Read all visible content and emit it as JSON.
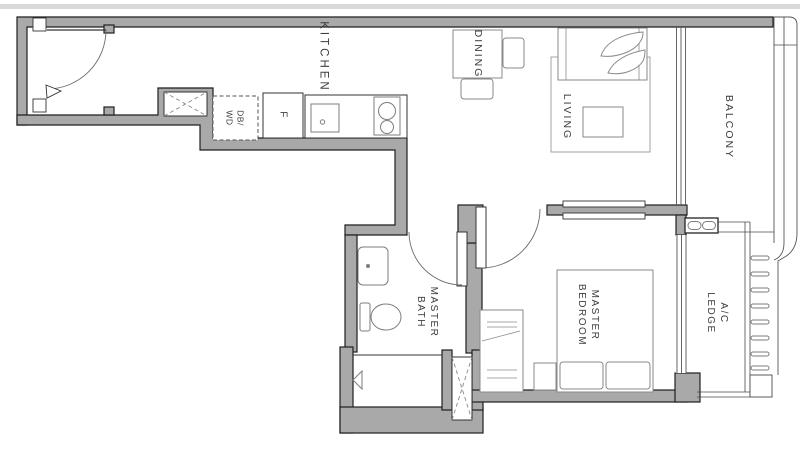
{
  "labels": {
    "kitchen": "KITCHEN",
    "dining": "DINING",
    "living": "LIVING",
    "balcony": "BALCONY",
    "master_bedroom": "MASTER\nBEDROOM",
    "master_bath": "MASTER\nBATH",
    "ac_ledge": "A/C\nLEDGE",
    "db_wd": "DB/\nWD",
    "fridge": "F"
  },
  "colors": {
    "wall_fill": "#a9a9a9",
    "wall_outline": "#1f1f1f",
    "fixture_line": "#7d7d7d",
    "furniture_line": "#8a8a8a",
    "label_text": "#3c3c3c",
    "background": "#ffffff",
    "top_strip": "#d9d9d9"
  }
}
